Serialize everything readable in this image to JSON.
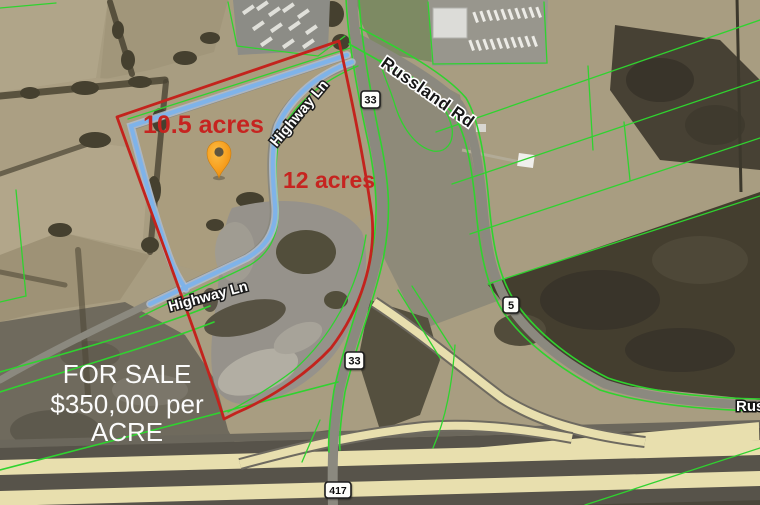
{
  "map": {
    "parcel_labels": {
      "parcel_a": "10.5 acres",
      "parcel_b": "12 acres"
    },
    "sale_sign": {
      "line1": "FOR SALE",
      "line2": "$350,000 per",
      "line3": "ACRE"
    },
    "road_labels": {
      "russland_rd": "Russland Rd",
      "highway_ln_upper": "Highway Ln",
      "highway_ln_lower": "Highway Ln",
      "russland_rd_east": "Russland Rd"
    },
    "route_shields": {
      "route_33": "33",
      "route_5": "5",
      "route_417": "417"
    },
    "colors": {
      "boundary_red": "#c3231d",
      "parcel_line_green": "#2fd32f",
      "road_blue": "#7fb3e9",
      "pin_orange": "#f7a61f",
      "highway_yellow": "#e8dfae",
      "acre_text_red": "#c62420",
      "sale_text_white": "#fbfbfb"
    }
  }
}
